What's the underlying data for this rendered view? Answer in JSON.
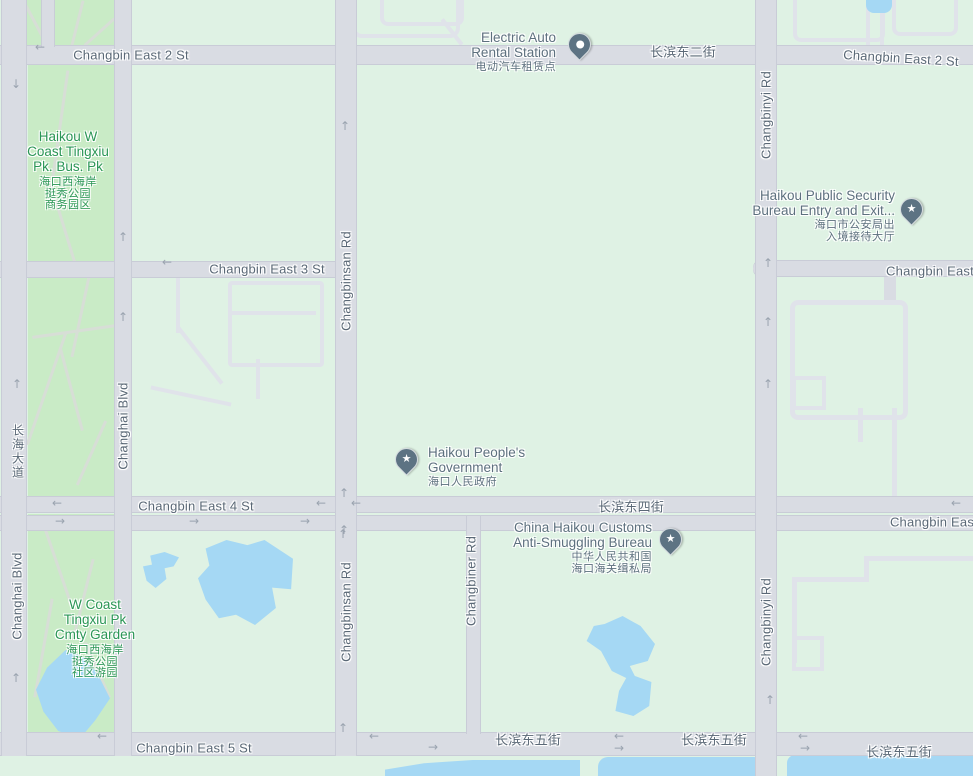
{
  "map": {
    "streets": {
      "changbin_east_2": "Changbin East 2 St",
      "changbin_east_2_cn": "长滨东二街",
      "changbin_east_3": "Changbin East 3 St",
      "changbin_east_3_cut": "Changbin East",
      "changbin_east_4": "Changbin East 4 St",
      "changbin_east_4_cn": "长滨东四街",
      "changbin_east_4_cut": "Changbin Eas",
      "changbin_east_5": "Changbin East 5 St",
      "changbin_east_5_cn": "长滨东五街",
      "changbinsan_rd": "Changbinsan Rd",
      "changbiner_rd": "Changbiner Rd",
      "changbinyi_rd": "Changbinyi Rd",
      "changhai_blvd": "Changhai Blvd",
      "changhai_blvd_cn": "长海大道"
    },
    "parks": [
      {
        "name": "Haikou W\nCoast Tingxiu\nPk. Bus. Pk",
        "name_cn": "海口西海岸\n挺秀公园\n商务园区"
      },
      {
        "name": "W Coast\nTingxiu Pk\nCmty Garden",
        "name_cn": "海口西海岸\n挺秀公园\n社区游园"
      }
    ],
    "pois": [
      {
        "name": "Electric Auto\nRental Station",
        "name_cn": "电动汽车租赁点",
        "marker": "dot-pin"
      },
      {
        "name": "Haikou Public Security\nBureau Entry and Exit...",
        "name_cn": "海口市公安局出\n入境接待大厅",
        "marker": "star-pin"
      },
      {
        "name": "Haikou People's\nGovernment",
        "name_cn": "海口人民政府",
        "marker": "star-pin"
      },
      {
        "name": "China Haikou Customs\nAnti-Smuggling Bureau",
        "name_cn": "中华人民共和国\n海口海关缉私局",
        "marker": "star-pin"
      }
    ],
    "icons": {
      "star": "★"
    },
    "colors": {
      "land": "#dff2e4",
      "park": "#c9ebc6",
      "road": "#d9dce3",
      "water": "#a5d8f4",
      "street_label": "#5a6876",
      "park_label": "#2a9655",
      "poi_label": "#5d707e",
      "pin": "#5d7383"
    },
    "arrows": [
      {
        "g": "←",
        "x": 40,
        "y": 47
      },
      {
        "g": "↓",
        "x": 16,
        "y": 84
      },
      {
        "g": "↑",
        "x": 17,
        "y": 384
      },
      {
        "g": "↑",
        "x": 16,
        "y": 678
      },
      {
        "g": "↑",
        "x": 123,
        "y": 237
      },
      {
        "g": "↑",
        "x": 123,
        "y": 317
      },
      {
        "g": "←",
        "x": 167,
        "y": 262
      },
      {
        "g": "↑",
        "x": 345,
        "y": 126
      },
      {
        "g": "↑",
        "x": 343,
        "y": 534
      },
      {
        "g": "↑",
        "x": 768,
        "y": 263
      },
      {
        "g": "↑",
        "x": 768,
        "y": 322
      },
      {
        "g": "↑",
        "x": 768,
        "y": 384
      },
      {
        "g": "↑",
        "x": 770,
        "y": 700
      },
      {
        "g": "←",
        "x": 57,
        "y": 503
      },
      {
        "g": "→",
        "x": 60,
        "y": 521
      },
      {
        "g": "→",
        "x": 194,
        "y": 521
      },
      {
        "g": "→",
        "x": 305,
        "y": 521
      },
      {
        "g": "←",
        "x": 321,
        "y": 503
      },
      {
        "g": "↑",
        "x": 344,
        "y": 493
      },
      {
        "g": "↑",
        "x": 344,
        "y": 530
      },
      {
        "g": "←",
        "x": 356,
        "y": 503
      },
      {
        "g": "←",
        "x": 956,
        "y": 503
      },
      {
        "g": "←",
        "x": 102,
        "y": 736
      },
      {
        "g": "↑",
        "x": 343,
        "y": 728
      },
      {
        "g": "←",
        "x": 374,
        "y": 736
      },
      {
        "g": "→",
        "x": 433,
        "y": 747
      },
      {
        "g": "←",
        "x": 619,
        "y": 736
      },
      {
        "g": "→",
        "x": 619,
        "y": 748
      },
      {
        "g": "←",
        "x": 803,
        "y": 736
      },
      {
        "g": "→",
        "x": 805,
        "y": 748
      }
    ]
  }
}
